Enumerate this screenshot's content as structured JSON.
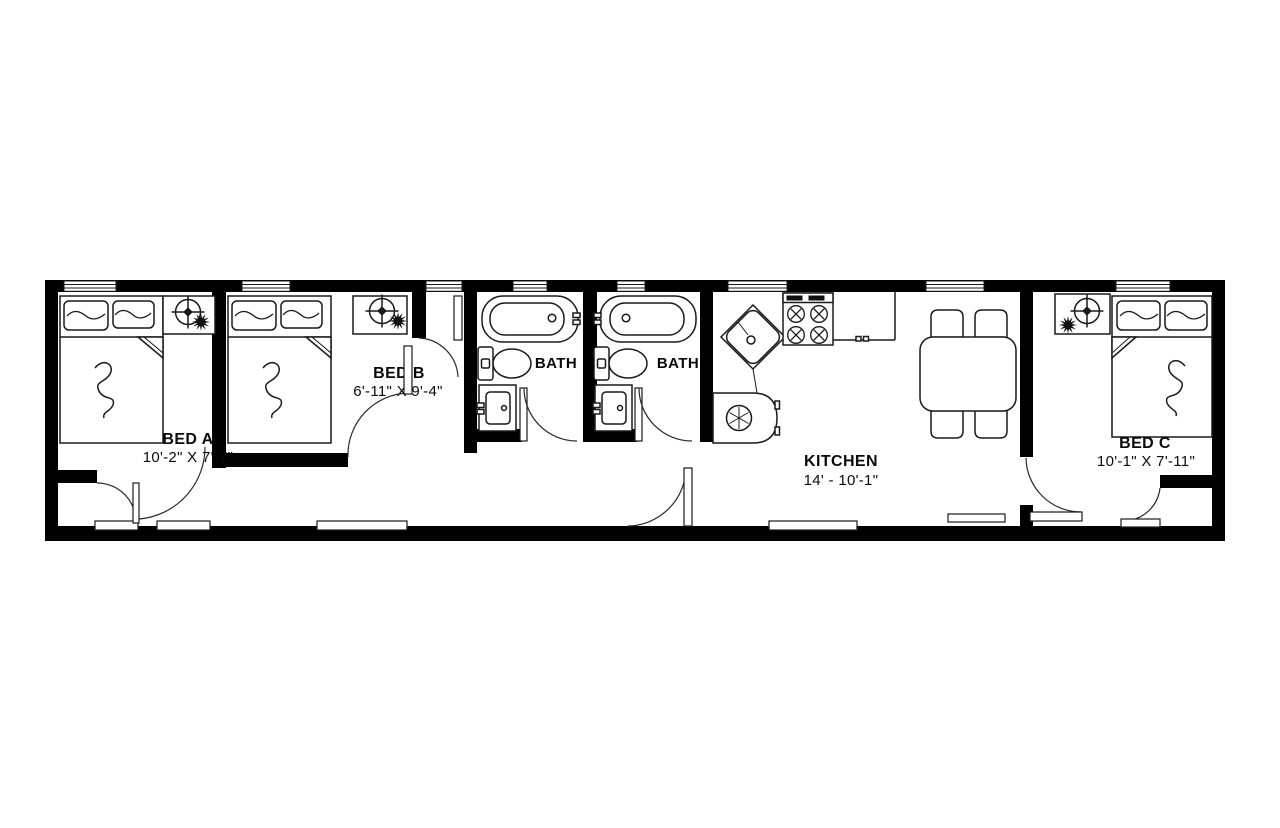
{
  "rooms": {
    "bed_a": {
      "name": "BED A",
      "dims": "10'-2\" X 7'-7\""
    },
    "bed_b": {
      "name": "BED B",
      "dims": "6'-11\" X 9'-4\""
    },
    "bath_1": {
      "name": "BATH"
    },
    "bath_2": {
      "name": "BATH"
    },
    "kitchen": {
      "name": "KITCHEN",
      "dims": "14' - 10'-1\""
    },
    "bed_c": {
      "name": "BED C",
      "dims": "10'-1\" X 7'-11\""
    }
  },
  "colors": {
    "wall": "#000000",
    "line": "#1a1a1a",
    "background": "#ffffff",
    "text": "#0a0a0a"
  }
}
